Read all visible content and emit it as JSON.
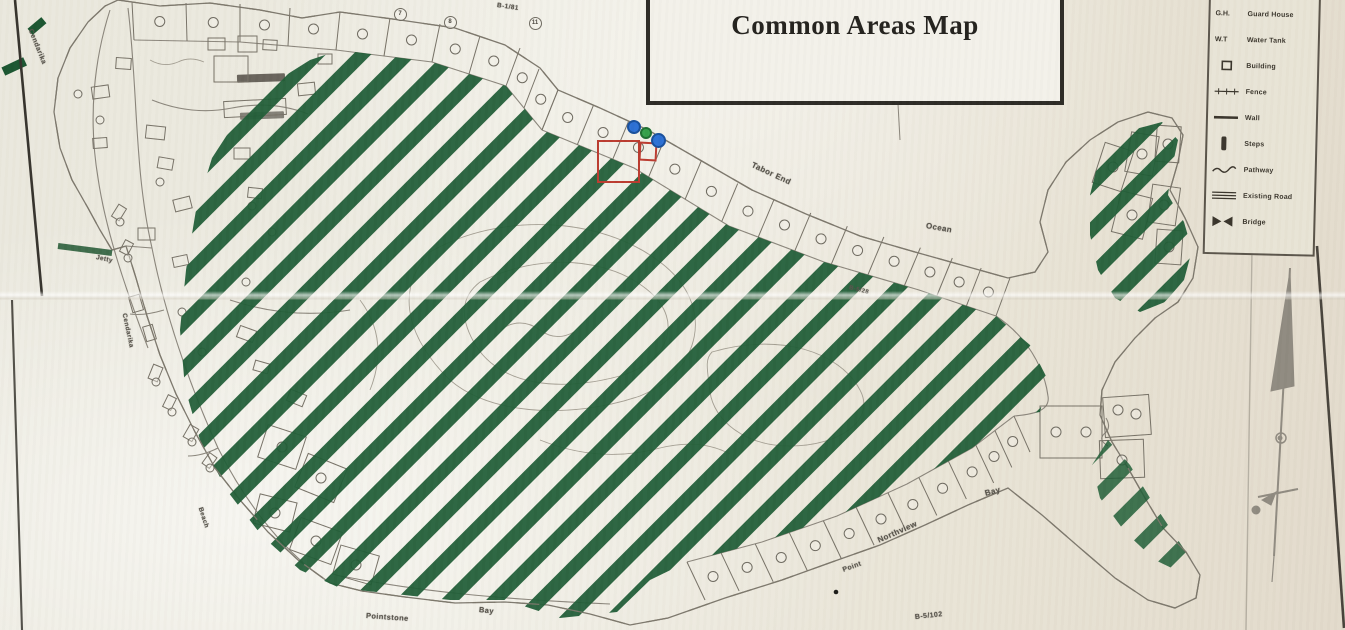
{
  "title": "Common Areas Map",
  "legend": {
    "items": [
      {
        "symbol": "abbr",
        "abbr": "G.H.",
        "label": "Guard House"
      },
      {
        "symbol": "abbr",
        "abbr": "W.T",
        "label": "Water Tank"
      },
      {
        "symbol": "building",
        "label": "Building"
      },
      {
        "symbol": "fence",
        "label": "Fence"
      },
      {
        "symbol": "wall",
        "label": "Wall"
      },
      {
        "symbol": "steps",
        "label": "Steps"
      },
      {
        "symbol": "pathway",
        "label": "Pathway"
      },
      {
        "symbol": "existing-road",
        "label": "Existing Road"
      },
      {
        "symbol": "bridge",
        "label": "Bridge"
      }
    ]
  },
  "map_labels": [
    {
      "id": "cendarika-nw",
      "text": "Cendarika",
      "x": 30,
      "y": 26,
      "rot": 68,
      "size": 7
    },
    {
      "id": "jetty",
      "text": "Jetty",
      "x": 96,
      "y": 254,
      "rot": 12,
      "size": 6.5
    },
    {
      "id": "cendarika-w",
      "text": "Cendarika",
      "x": 124,
      "y": 310,
      "rot": 78,
      "size": 6.5
    },
    {
      "id": "beach",
      "text": "Beach",
      "x": 200,
      "y": 504,
      "rot": 72,
      "size": 6.5
    },
    {
      "id": "tabor-end",
      "text": "Tabor End",
      "x": 752,
      "y": 160,
      "rot": 25,
      "size": 8
    },
    {
      "id": "ocean",
      "text": "Ocean",
      "x": 926,
      "y": 221,
      "rot": 10,
      "size": 8
    },
    {
      "id": "bay-east",
      "text": "Bay",
      "x": 985,
      "y": 489,
      "rot": -15,
      "size": 8
    },
    {
      "id": "northview",
      "text": "Northview",
      "x": 878,
      "y": 536,
      "rot": -24,
      "size": 8
    },
    {
      "id": "point",
      "text": "Point",
      "x": 843,
      "y": 567,
      "rot": -20,
      "size": 7
    },
    {
      "id": "pointstone",
      "text": "Pointstone",
      "x": 366,
      "y": 611,
      "rot": 4,
      "size": 7.5
    },
    {
      "id": "bay-south",
      "text": "Bay",
      "x": 479,
      "y": 605,
      "rot": 6,
      "size": 7.5
    },
    {
      "id": "lot-b1-81",
      "text": "B-1/81",
      "x": 497,
      "y": 2,
      "rot": 8,
      "size": 6.5
    },
    {
      "id": "lot-b5-28",
      "text": "B-5/28",
      "x": 849,
      "y": 285,
      "rot": 14,
      "size": 6
    },
    {
      "id": "lot-b5-102",
      "text": "B-5/102",
      "x": 915,
      "y": 614,
      "rot": -6,
      "size": 7
    }
  ],
  "lot_numbers": [
    {
      "text": "7",
      "x": 399,
      "y": 13
    },
    {
      "text": "8",
      "x": 449,
      "y": 21
    },
    {
      "text": "11",
      "x": 534,
      "y": 22
    }
  ],
  "markers": [
    {
      "id": "marker-blue-1",
      "kind": "blue",
      "x": 634,
      "y": 127,
      "r": 7
    },
    {
      "id": "marker-green",
      "kind": "green",
      "x": 646,
      "y": 133,
      "r": 6
    },
    {
      "id": "marker-blue-2",
      "kind": "blue",
      "x": 658,
      "y": 140,
      "r": 7.5
    }
  ],
  "highlight": {
    "x": 597,
    "y": 140,
    "w": 43,
    "h": 43,
    "x2": 639,
    "y2": 142,
    "w2": 18,
    "h2": 19
  },
  "colors": {
    "hatch_green": "#1e5c35",
    "dash_green": "#1a5530",
    "highlight_red": "#bb3a2e",
    "marker_blue": "#2b6fd4",
    "marker_blue_ring": "#174f9c",
    "marker_green": "#35a04a",
    "marker_green_ring": "#1d6e30",
    "paper": "#eceade",
    "ink": "#6e6a60"
  }
}
